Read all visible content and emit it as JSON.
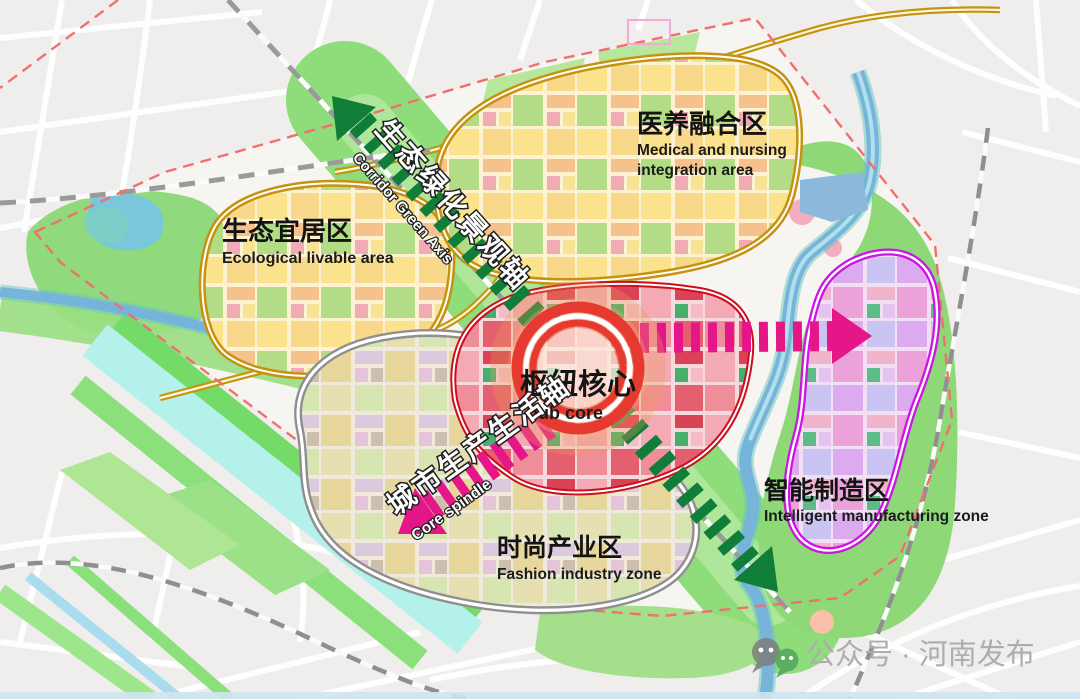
{
  "map": {
    "zones": [
      {
        "name_zh": "生态宜居区",
        "name_en": "Ecological livable area",
        "border_color": "#c59310"
      },
      {
        "name_zh": "医养融合区",
        "name_en_line1": "Medical and nursing",
        "name_en_line2": "integration area",
        "border_color": "#c59310"
      },
      {
        "name_zh": "枢纽核心",
        "name_en": "hub core",
        "border_color": "#cb0f1f"
      },
      {
        "name_zh": "时尚产业区",
        "name_en": "Fashion industry zone",
        "border_color": "#8f8f8f"
      },
      {
        "name_zh": "智能制造区",
        "name_en": "Intelligent manufacturing zone",
        "border_color": "#cc14e4"
      }
    ],
    "axes": [
      {
        "name_zh": "生态绿化景观轴",
        "name_en": "Corridor Green Axis",
        "color": "#107d38"
      },
      {
        "name_zh": "城市生产生活轴",
        "name_en": "Core spindle",
        "color": "#e41688"
      }
    ],
    "symbols": [
      {
        "name": "hub-ring",
        "color": "#e63a30"
      },
      {
        "name": "site-boundary",
        "style": "red-dashed",
        "color": "#f07070"
      }
    ],
    "watermark": {
      "text": "公众号 · 河南发布"
    }
  }
}
